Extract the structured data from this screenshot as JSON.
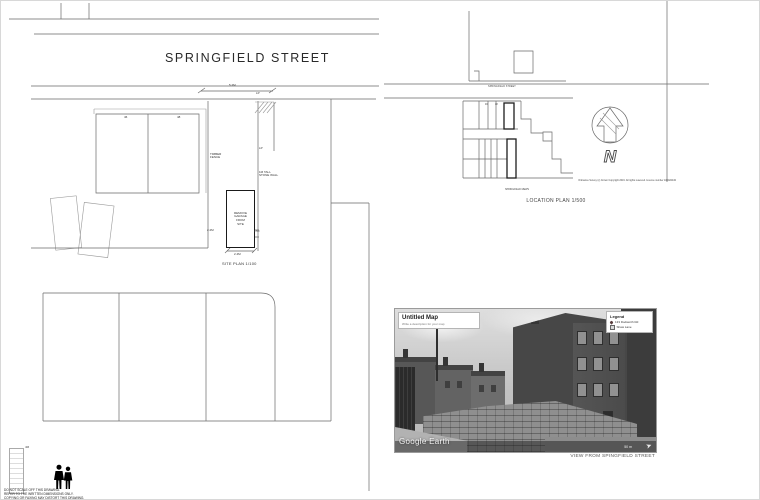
{
  "site_plan": {
    "title": "SPRINGFIELD STREET",
    "dims": {
      "top": "5.2M",
      "left": "2.2M",
      "bottom": "2.4M",
      "right": "0.5M"
    },
    "house_left": "46",
    "house_right": "48",
    "labels": {
      "timber_fence_1": "TIMBER",
      "timber_fence_2": "FENCE",
      "lp": "LP",
      "stone_wall_1": "1M TALL",
      "stone_wall_2": "STONE WALL"
    },
    "garage": [
      "REMOVE",
      "GARAGE",
      "FROM",
      "SITE"
    ],
    "scale_label": "SITE PLAN 1/100"
  },
  "location_plan": {
    "street_label": "SPRINGFIELD STREET",
    "mews_label": "SPRINGFIELD MEWS",
    "title": "LOCATION PLAN 1/500",
    "copyright": "Ordnance Survey (c) Crown Copyright 2019. All rights reserved. Licence number 100022432",
    "north_letter": "N",
    "house_left": "46",
    "house_right": "48"
  },
  "photo": {
    "map_title": "Untitled Map",
    "map_subtitle": "Write a description for your map",
    "legend_title": "Legend",
    "legend": [
      "133 Dodworth Rd",
      "Shaw Lane"
    ],
    "watermark": "Google Earth",
    "scale_text": "50 m",
    "compass_glyph": "➤",
    "caption": "VIEW FROM SPINGFIELD STREET"
  },
  "footer": {
    "scale_label": "4M",
    "disclaimer": [
      "DO NOT SCALE OFF THIS DRAWING.",
      "REFER TO THE WRITTEN DIMENSIONS ONLY.",
      "COPYING OR FAXING MAY DISTORT THIS DRAWING."
    ]
  }
}
